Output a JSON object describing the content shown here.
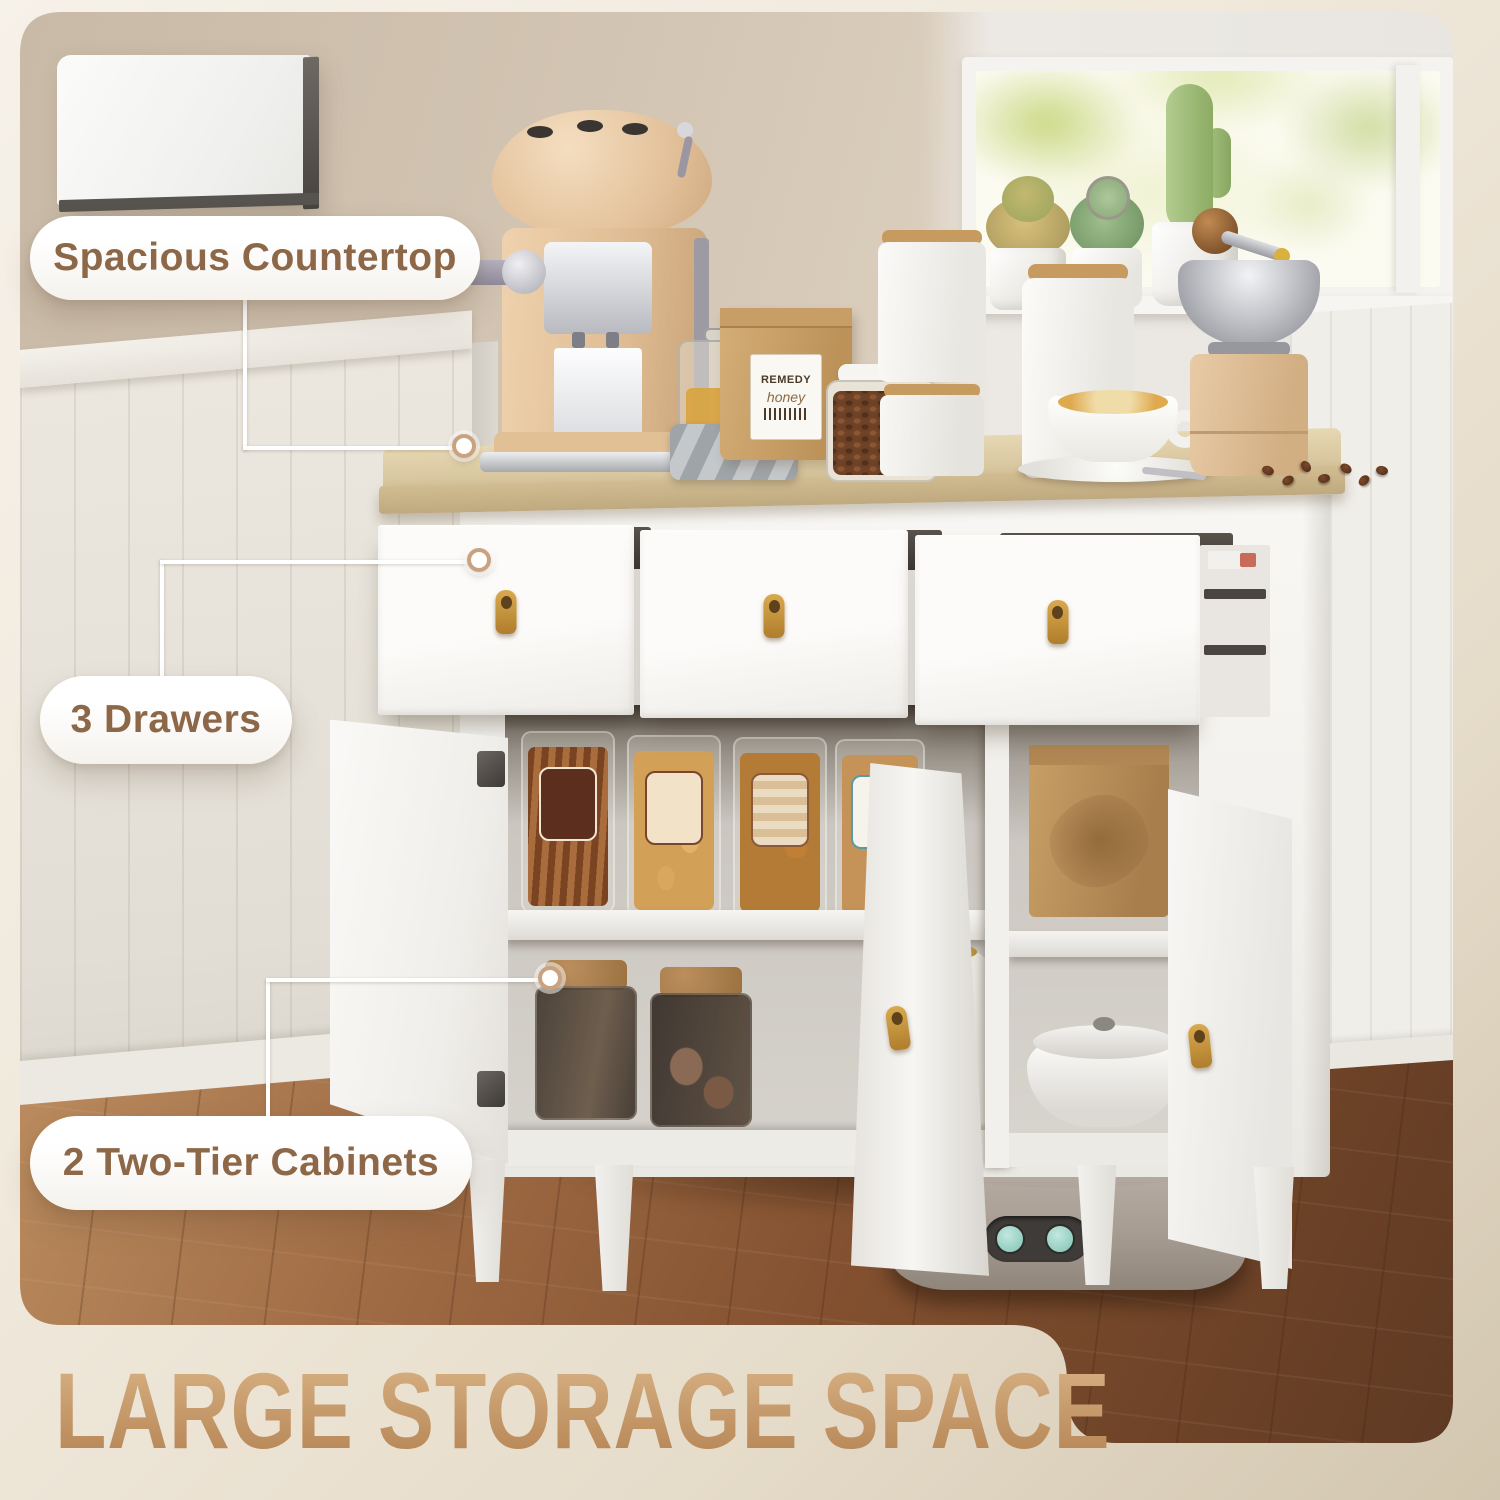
{
  "title": {
    "text": "LARGE STORAGE SPACE"
  },
  "callouts": [
    {
      "id": "countertop",
      "label": "Spacious Countertop"
    },
    {
      "id": "drawers",
      "label": "3 Drawers"
    },
    {
      "id": "cabinets",
      "label": "2 Two-Tier Cabinets"
    }
  ],
  "scene": {
    "bag_label_line1": "REMEDY",
    "bag_label_line2": "honey"
  },
  "colors": {
    "accent_text": "#8D6848",
    "title_gold_light": "#D3AC7E",
    "title_gold_dark": "#BA8A5A",
    "pill_bg": "#FFFFFF",
    "connector": "#FFFFFF",
    "dot_ring": "#C79A74",
    "wall_beige": "#CFC0AD",
    "wainscot_white": "#E8E4DC",
    "counter_wood": "#D9C8A2",
    "cabinet_white": "#F6F5F2",
    "leather_pull_gold": "#C8963E",
    "floor_brown": "#82502F",
    "vacuum_gray": "#A79D93",
    "vacuum_button_teal": "#9ED6C8",
    "window_greenery": "#BACD78",
    "honey_amber": "#D9A33C",
    "kraft_tan": "#C8A066"
  }
}
